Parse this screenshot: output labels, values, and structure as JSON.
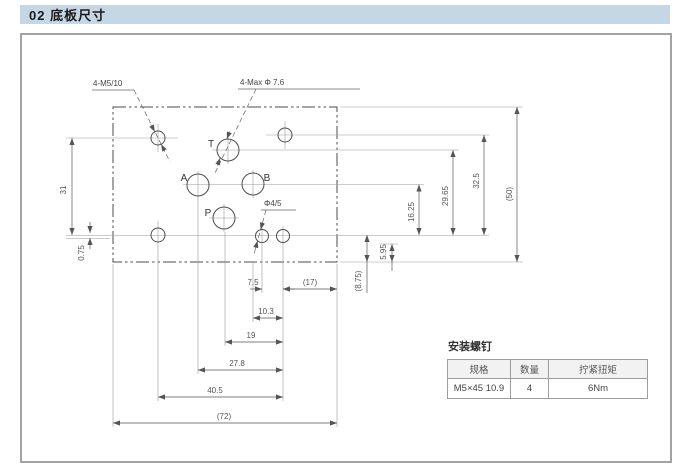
{
  "header": {
    "title": "02 底板尺寸"
  },
  "drawing": {
    "callouts": {
      "mounting_holes": "4-M5/10",
      "port_max_dia": "4-Max Φ 7.6",
      "pilot_hole": "Φ4/5"
    },
    "ports": {
      "t": "T",
      "a": "A",
      "b": "B",
      "p": "P"
    },
    "dims": {
      "v_left": "31",
      "v_left_offset": "0.75",
      "v_ab": "16.25",
      "v_t": "29.65",
      "v_top_right": "32.5",
      "v_overall": "(50)",
      "v_pilot_edge": "5.95",
      "v_row_edge": "(8.75)",
      "h_pilot_screw": "7.5",
      "h_screw_edge": "(17)",
      "h_b_screw": "10.3",
      "h_p_screw": "19",
      "h_a_screw": "27.8",
      "h_screw_span": "40.5",
      "h_overall": "(72)"
    }
  },
  "screw_table": {
    "title": "安装螺钉",
    "headers": [
      "规格",
      "数量",
      "拧紧扭矩"
    ],
    "row": [
      "M5×45 10.9",
      "4",
      "6Nm"
    ]
  }
}
